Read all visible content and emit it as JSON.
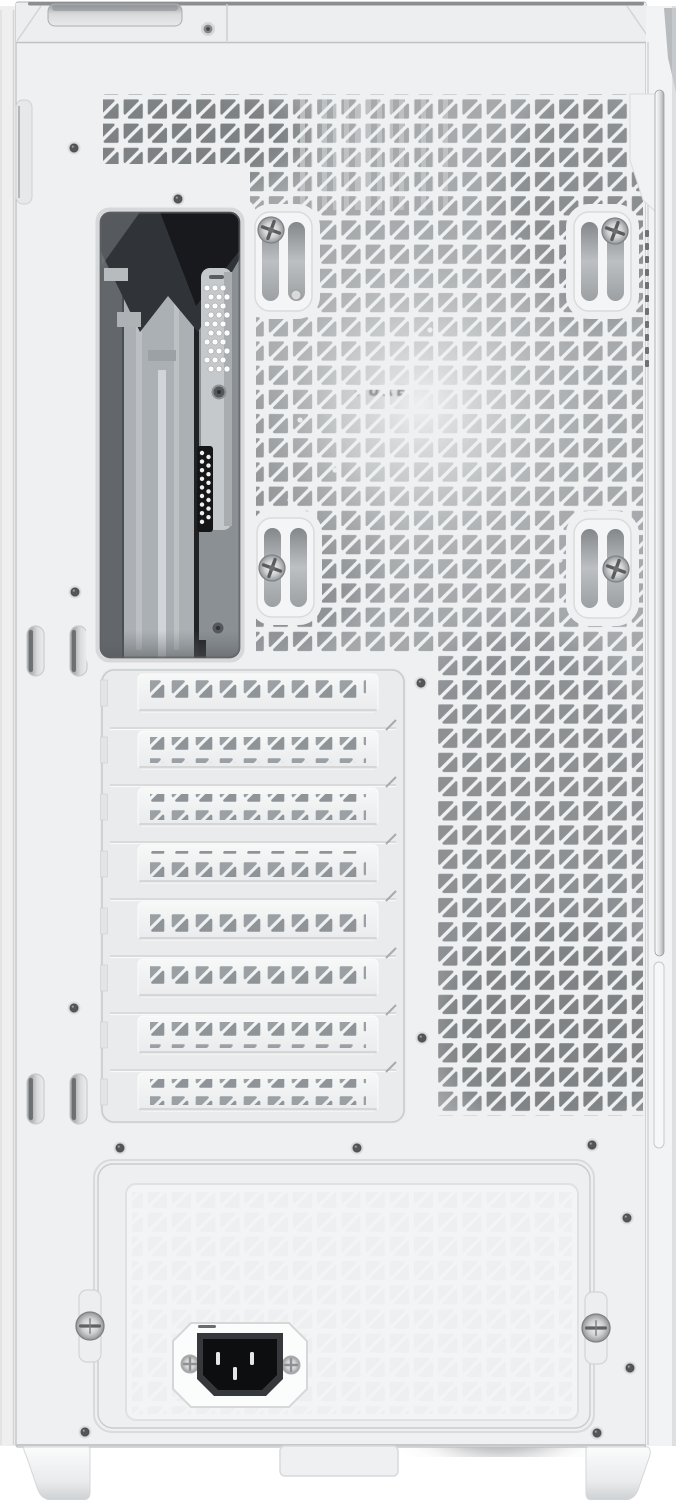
{
  "meta": {
    "caption": "Rear view of a white ATX mid-tower PC case",
    "type": "product-photo"
  },
  "palette": {
    "case_white": "#eff0f1",
    "recess_gray": "#e9ebec",
    "interior_gray": "#a6aaad",
    "io_dark": "#2b2e31",
    "screw_silver": "#c7c9cb",
    "inlet_black": "#0c0e10"
  },
  "parts": {
    "top_panel": {
      "handle_recess": true,
      "screw_count": 1
    },
    "rear_mesh": {
      "pattern": "triangular-perforations"
    },
    "fan_mount": {
      "slotted_rails": 4,
      "screws": 4
    },
    "fan": {
      "visible_behind_mesh": true,
      "logo_text": "PURE"
    },
    "io_cutout": {
      "perforated_bracket": true,
      "screws": 2
    },
    "expansion_slots": {
      "count": 8,
      "style": "vented covers"
    },
    "psu_bay": {
      "thumbscrews": 2,
      "power_inlet": "IEC C14"
    },
    "feet": {
      "count": 2
    },
    "side_tabs": {
      "pairs": 2
    }
  }
}
